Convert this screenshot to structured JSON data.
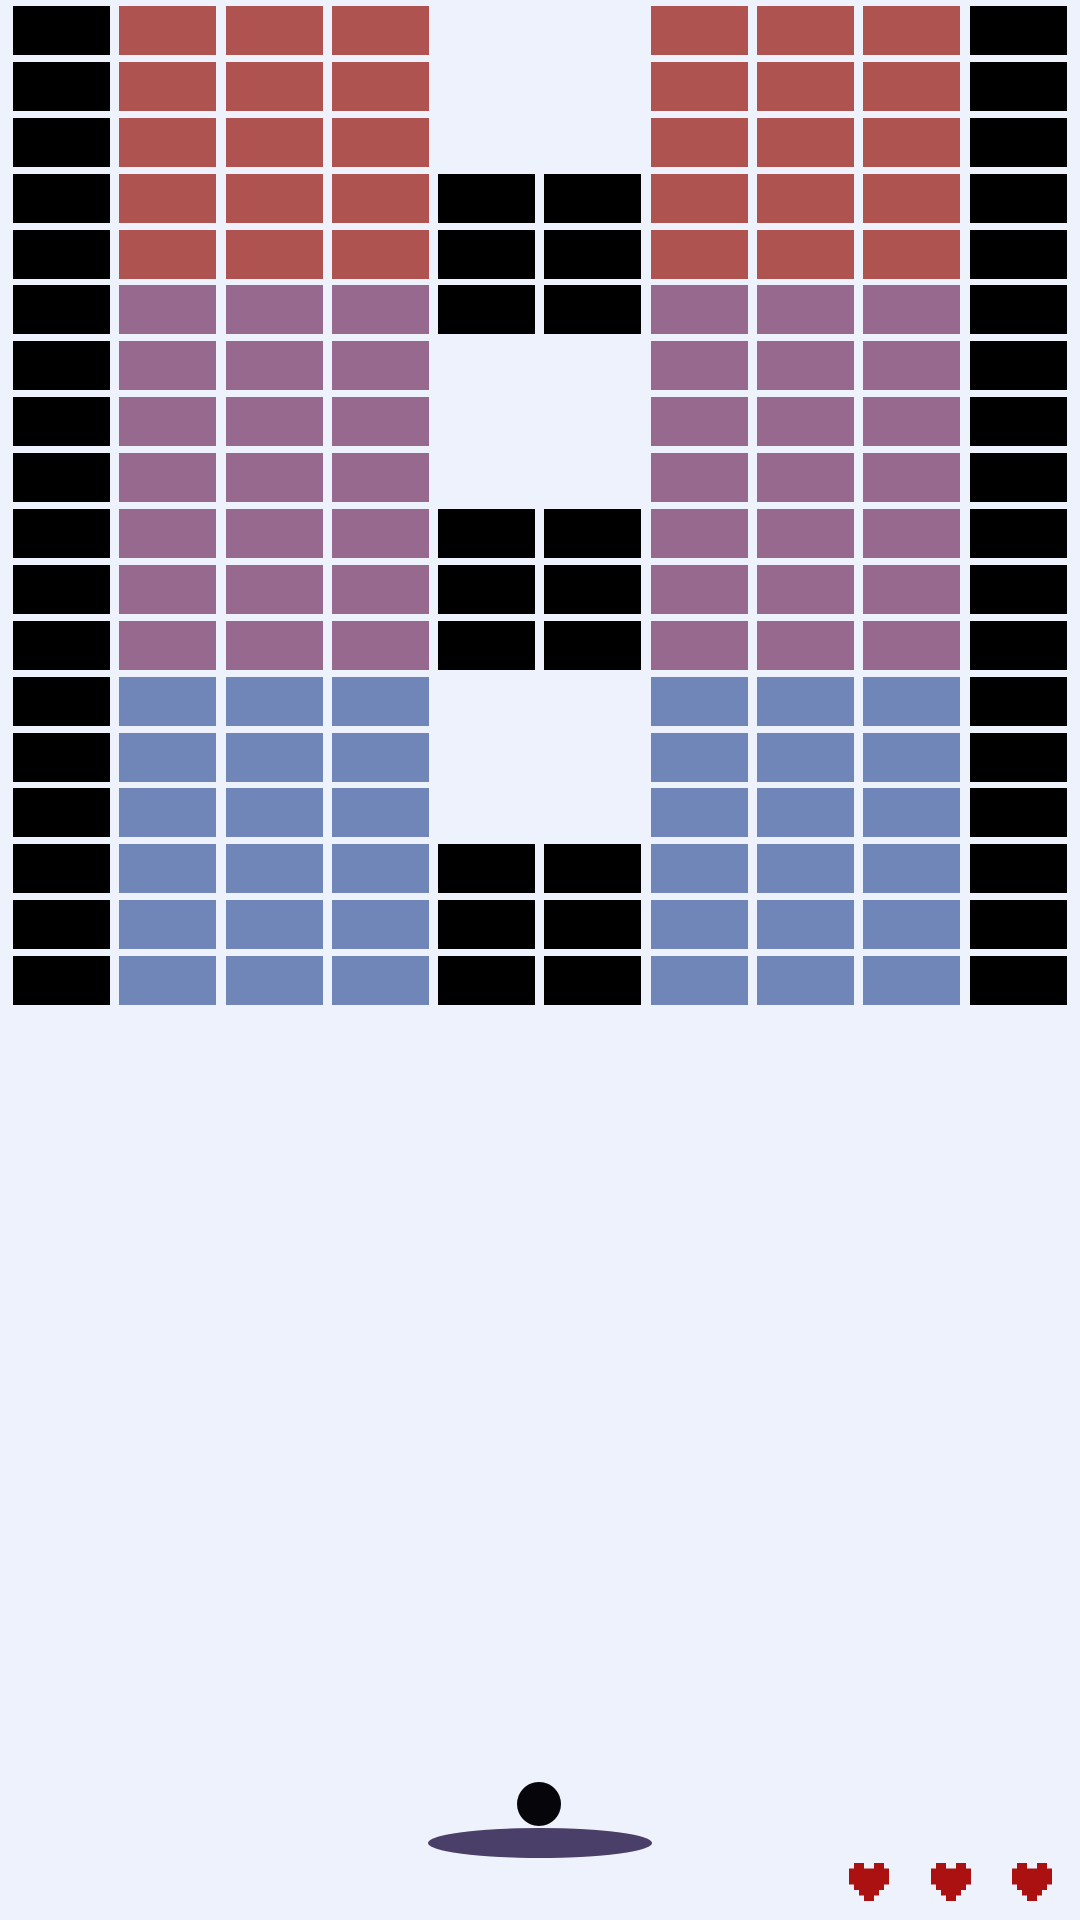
{
  "app": {
    "name": "brick-breaker-game"
  },
  "colors": {
    "background": "#eef2fc",
    "black_brick": "#000000",
    "red_brick": "#ae5350",
    "purple_brick": "#97698f",
    "blue_brick": "#7186b8",
    "paddle": "#4a3f68",
    "ball": "#06060a",
    "heart": "#ac1111"
  },
  "board": {
    "columns": 10,
    "rows": 18,
    "legend": {
      "K": "black",
      "R": "red",
      "P": "purple",
      "B": "blue",
      ".": "empty"
    },
    "cells": [
      "KRRR..RRRK",
      "KRRR..RRRK",
      "KRRR..RRRK",
      "KRRRKKRRRK",
      "KRRRKKRRRK",
      "KPPPKKPPPK",
      "KPPP..PPPK",
      "KPPP..PPPK",
      "KPPP..PPPK",
      "KPPPKKPPPK",
      "KPPPKKPPPK",
      "KPPPKKPPPK",
      "KBBB..BBBK",
      "KBBB..BBBK",
      "KBBB..BBBK",
      "KBBBKKBBBK",
      "KBBBKKBBBK",
      "KBBBKKBBBK"
    ]
  },
  "game": {
    "lives": 3,
    "ball": {
      "x": 539,
      "y": 1804,
      "diameter": 44
    },
    "paddle": {
      "x": 540,
      "y": 1843,
      "width": 224,
      "height": 30
    }
  }
}
